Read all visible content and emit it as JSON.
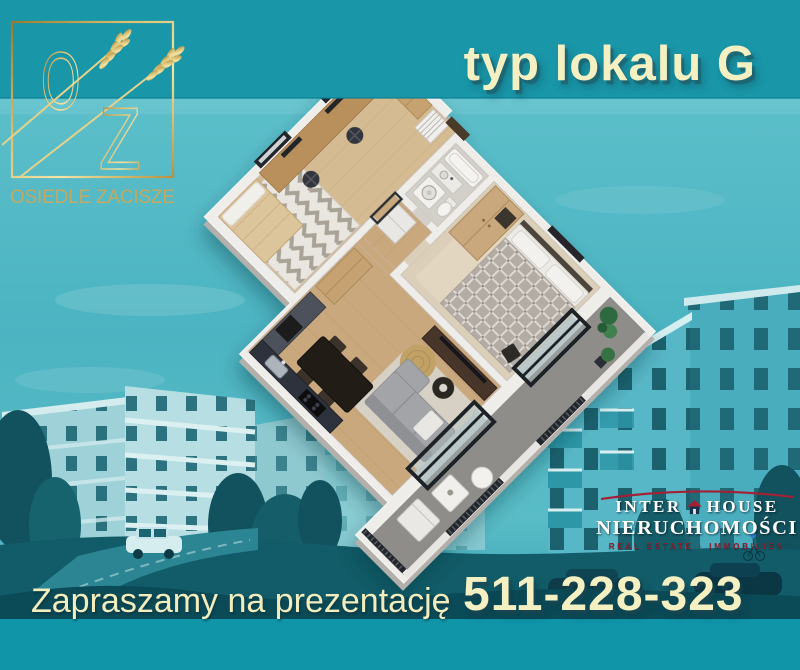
{
  "header": {
    "title": "typ lokalu G"
  },
  "brand_logo": {
    "monogram_top": "O",
    "monogram_bottom": "Z",
    "estate_name": "OSIEDLE ZACISZE"
  },
  "floor_plan": {
    "kind": "3d-isometric-apartment-floor-plan",
    "rooms": [
      "office",
      "bathroom",
      "hallway",
      "bedroom",
      "living-room-with-kitchen",
      "balcony"
    ]
  },
  "agency_logo": {
    "name_left": "INTER",
    "name_right": "HOUSE",
    "subtitle": "NIERUCHOMOŚCI",
    "tagline": "REAL ESTATE · IMMOBILIEN"
  },
  "footer": {
    "tagline": "Zapraszamy na prezentację",
    "phone": "511-228-323"
  },
  "colors": {
    "header_band": "#1996a8",
    "footer_band": "#1095a8",
    "accent_cream": "#f5f0c2",
    "brand_gold": "#c9a95c",
    "agency_red": "#a32035"
  }
}
